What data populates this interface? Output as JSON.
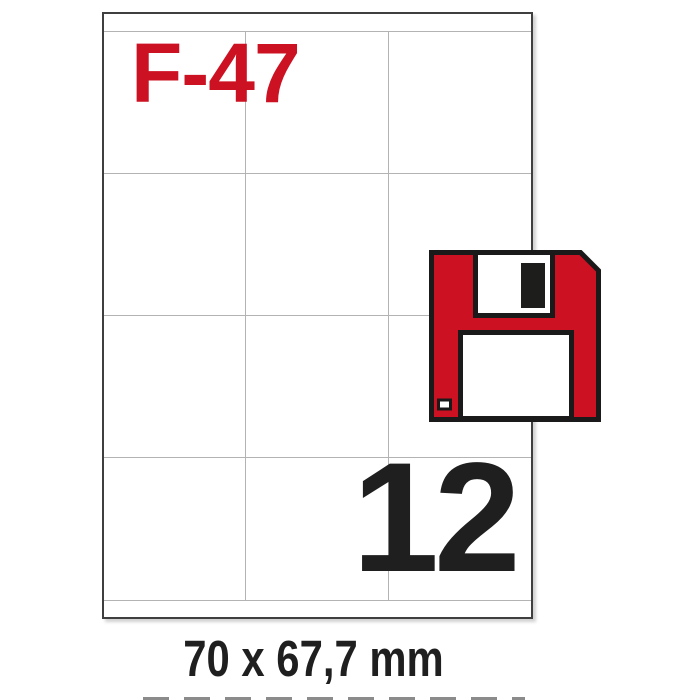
{
  "product": {
    "code": "F-47",
    "labels_per_sheet": "12",
    "label_size": "70 x 67,7 mm"
  },
  "sheet": {
    "type": "A4 label sheet",
    "grid": {
      "columns": 3,
      "rows": 4
    }
  },
  "icon": {
    "name": "floppy-disk-icon"
  },
  "colors": {
    "accent_red": "#cc1122",
    "text_dark": "#1f1f1f",
    "grid_line": "#b3b3b3",
    "sheet_border": "#3f3f3f",
    "floppy_outline": "#1a1a1a"
  }
}
